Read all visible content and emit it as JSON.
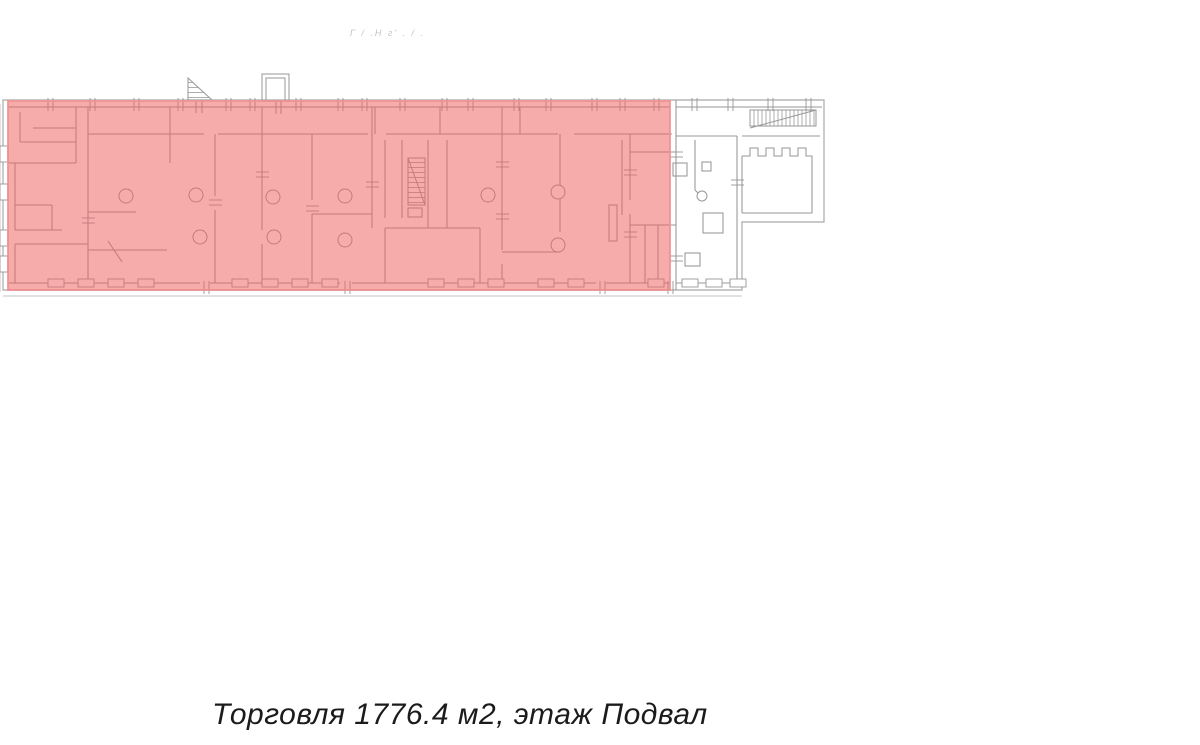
{
  "page": {
    "background_color": "#ffffff"
  },
  "watermark": {
    "text": "Г / .Н г' . / ."
  },
  "floor_plan": {
    "outline_color": "#a9a9a9",
    "line_color": "#979797",
    "faint_line_color": "#cfcfcf",
    "highlight": {
      "fill_color": "#ef5f5f",
      "border_color": "#f08f8f",
      "use": "Торговля",
      "area_m2": 1776.4,
      "floor": "Подвал"
    }
  },
  "caption": {
    "text": "Торговля 1776.4 м2, этаж Подвал"
  }
}
